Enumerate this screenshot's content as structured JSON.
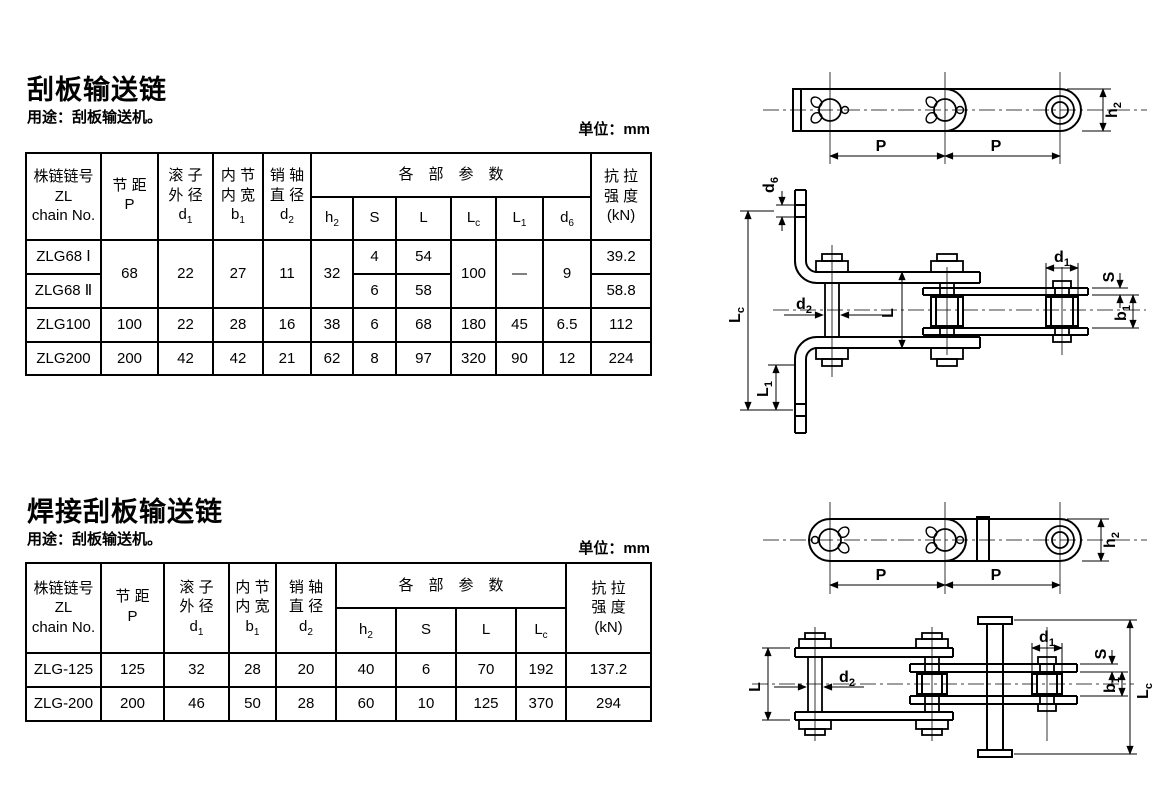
{
  "section1": {
    "title": "刮板输送链",
    "usage": "用途：刮板输送机。",
    "unit": "单位：mm",
    "table": {
      "h": {
        "chain": [
          "株链链号",
          "ZL",
          "chain No."
        ],
        "pitch_cn": "节 距",
        "pitch_sym": {
          "b": "P",
          "s": ""
        },
        "roller_cn": [
          "滚 子",
          "外 径"
        ],
        "roller_sym": {
          "b": "d",
          "s": "1"
        },
        "width_cn": [
          "内 节",
          "内 宽"
        ],
        "width_sym": {
          "b": "b",
          "s": "1"
        },
        "pin_cn": [
          "销 轴",
          "直 径"
        ],
        "pin_sym": {
          "b": "d",
          "s": "2"
        },
        "params_group": "各　部　参　数",
        "params": [
          {
            "b": "h",
            "s": "2"
          },
          {
            "b": "S",
            "s": ""
          },
          {
            "b": "L",
            "s": ""
          },
          {
            "b": "L",
            "s": "c"
          },
          {
            "b": "L",
            "s": "1"
          },
          {
            "b": "d",
            "s": "6"
          }
        ],
        "strength": [
          "抗 拉",
          "强 度",
          "(kN)"
        ]
      },
      "rows": [
        {
          "name": "ZLG68 Ⅰ",
          "p": "68",
          "d1": "22",
          "b1": "27",
          "d2": "11",
          "h2": "32",
          "s": "4",
          "l": "54",
          "lc": "100",
          "l1": "—",
          "d6": "9",
          "kn": "39.2"
        },
        {
          "name": "ZLG68 Ⅱ",
          "s": "6",
          "l": "58",
          "kn": "58.8"
        },
        {
          "name": "ZLG100",
          "p": "100",
          "d1": "22",
          "b1": "28",
          "d2": "16",
          "h2": "38",
          "s": "6",
          "l": "68",
          "lc": "180",
          "l1": "45",
          "d6": "6.5",
          "kn": "112"
        },
        {
          "name": "ZLG200",
          "p": "200",
          "d1": "42",
          "b1": "42",
          "d2": "21",
          "h2": "62",
          "s": "8",
          "l": "97",
          "lc": "320",
          "l1": "90",
          "d6": "12",
          "kn": "224"
        }
      ]
    }
  },
  "section2": {
    "title": "焊接刮板输送链",
    "usage": "用途：刮板输送机。",
    "unit": "单位：mm",
    "table": {
      "h": {
        "chain": [
          "株链链号",
          "ZL",
          "chain No."
        ],
        "pitch_cn": "节 距",
        "pitch_sym": {
          "b": "P",
          "s": ""
        },
        "roller_cn": [
          "滚 子",
          "外 径"
        ],
        "roller_sym": {
          "b": "d",
          "s": "1"
        },
        "width_cn": [
          "内 节",
          "内 宽"
        ],
        "width_sym": {
          "b": "b",
          "s": "1"
        },
        "pin_cn": [
          "销 轴",
          "直 径"
        ],
        "pin_sym": {
          "b": "d",
          "s": "2"
        },
        "params_group": "各　部　参　数",
        "params": [
          {
            "b": "h",
            "s": "2"
          },
          {
            "b": "S",
            "s": ""
          },
          {
            "b": "L",
            "s": ""
          },
          {
            "b": "L",
            "s": "c"
          }
        ],
        "strength": [
          "抗 拉",
          "强 度",
          "(kN)"
        ]
      },
      "rows": [
        {
          "name": "ZLG-125",
          "p": "125",
          "d1": "32",
          "b1": "28",
          "d2": "20",
          "h2": "40",
          "s": "6",
          "l": "70",
          "lc": "192",
          "kn": "137.2"
        },
        {
          "name": "ZLG-200",
          "p": "200",
          "d1": "46",
          "b1": "50",
          "d2": "28",
          "h2": "60",
          "s": "10",
          "l": "125",
          "lc": "370",
          "kn": "294"
        }
      ]
    }
  },
  "diagrams": {
    "side_view": {
      "p1": "P",
      "p2": "P",
      "h2": {
        "b": "h",
        "s": "2"
      }
    },
    "assembly": {
      "d6": {
        "b": "d",
        "s": "6"
      },
      "lc": {
        "b": "L",
        "s": "c"
      },
      "l1": {
        "b": "L",
        "s": "1"
      },
      "d2": {
        "b": "d",
        "s": "2"
      },
      "l": {
        "b": "L",
        "s": ""
      },
      "d1": {
        "b": "d",
        "s": "1"
      },
      "s": {
        "b": "S",
        "s": ""
      },
      "b1": {
        "b": "b",
        "s": "1"
      }
    },
    "welded_side_view": {
      "p1": "P",
      "p2": "P",
      "h2": {
        "b": "h",
        "s": "2"
      }
    },
    "welded_assembly": {
      "l": {
        "b": "L",
        "s": ""
      },
      "d2": {
        "b": "d",
        "s": "2"
      },
      "d1": {
        "b": "d",
        "s": "1"
      },
      "s": {
        "b": "S",
        "s": ""
      },
      "b1": {
        "b": "b",
        "s": "1"
      },
      "lc": {
        "b": "L",
        "s": "c"
      }
    }
  }
}
